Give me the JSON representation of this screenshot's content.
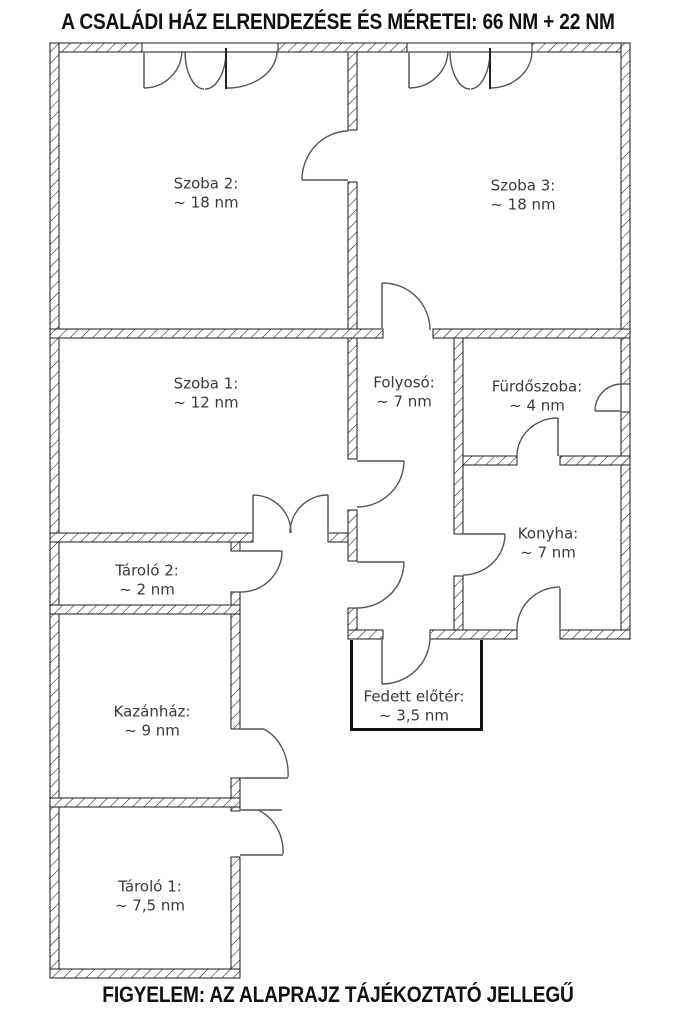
{
  "title": "A CSALÁDI HÁZ ELRENDEZÉSE ÉS MÉRETEI: 66 NM + 22 NM",
  "footer": "FIGYELEM: AZ ALAPRAJZ TÁJÉKOZTATÓ JELLEGŰ",
  "rooms": [
    {
      "id": "szoba-2",
      "name": "Szoba 2:",
      "area": "~ 18 nm"
    },
    {
      "id": "szoba-3",
      "name": "Szoba 3:",
      "area": "~ 18 nm"
    },
    {
      "id": "szoba-1",
      "name": "Szoba 1:",
      "area": "~ 12 nm"
    },
    {
      "id": "folyoso",
      "name": "Folyosó:",
      "area": "~ 7 nm"
    },
    {
      "id": "furdoszoba",
      "name": "Fürdőszoba:",
      "area": "~ 4 nm"
    },
    {
      "id": "konyha",
      "name": "Konyha:",
      "area": "~ 7 nm"
    },
    {
      "id": "tarolo-2",
      "name": "Tároló 2:",
      "area": "~ 2 nm"
    },
    {
      "id": "kazanhaz",
      "name": "Kazánház:",
      "area": "~ 9 nm"
    },
    {
      "id": "tarolo-1",
      "name": "Tároló 1:",
      "area": "~ 7,5 nm"
    },
    {
      "id": "fedett-eloter",
      "name": "Fedett előtér:",
      "area": "~ 3,5 nm"
    }
  ],
  "colors": {
    "background": "#ffffff",
    "wall_line": "#1a1a1a",
    "door_arc": "#555555",
    "door_leaf": "#808080",
    "text": "#3a3a3a"
  }
}
